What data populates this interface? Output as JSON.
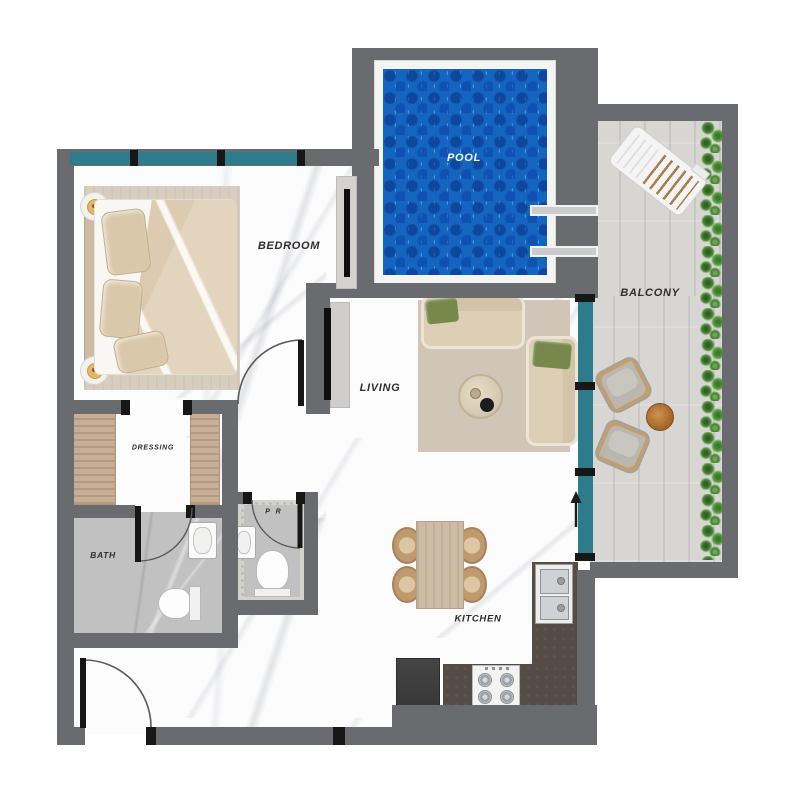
{
  "rooms": {
    "pool": {
      "label": "POOL"
    },
    "balcony": {
      "label": "BALCONY"
    },
    "bedroom": {
      "label": "BEDROOM"
    },
    "living": {
      "label": "LIVING"
    },
    "dressing": {
      "label": "DRESSING"
    },
    "bath": {
      "label": "BATH"
    },
    "powder_room": {
      "label": "P R"
    },
    "kitchen": {
      "label": "KITCHEN"
    }
  },
  "colors": {
    "wall": "#696b6e",
    "window_glazing": "#2e7b8b",
    "pool_water": "#1465c0",
    "balcony_deck": "#d3d1cd",
    "hedge_green": "#4c8a37",
    "counter": "#544c45",
    "rug": "#d7cec0",
    "sofa": "#dccfb6",
    "accent_pillow": "#76884a"
  }
}
